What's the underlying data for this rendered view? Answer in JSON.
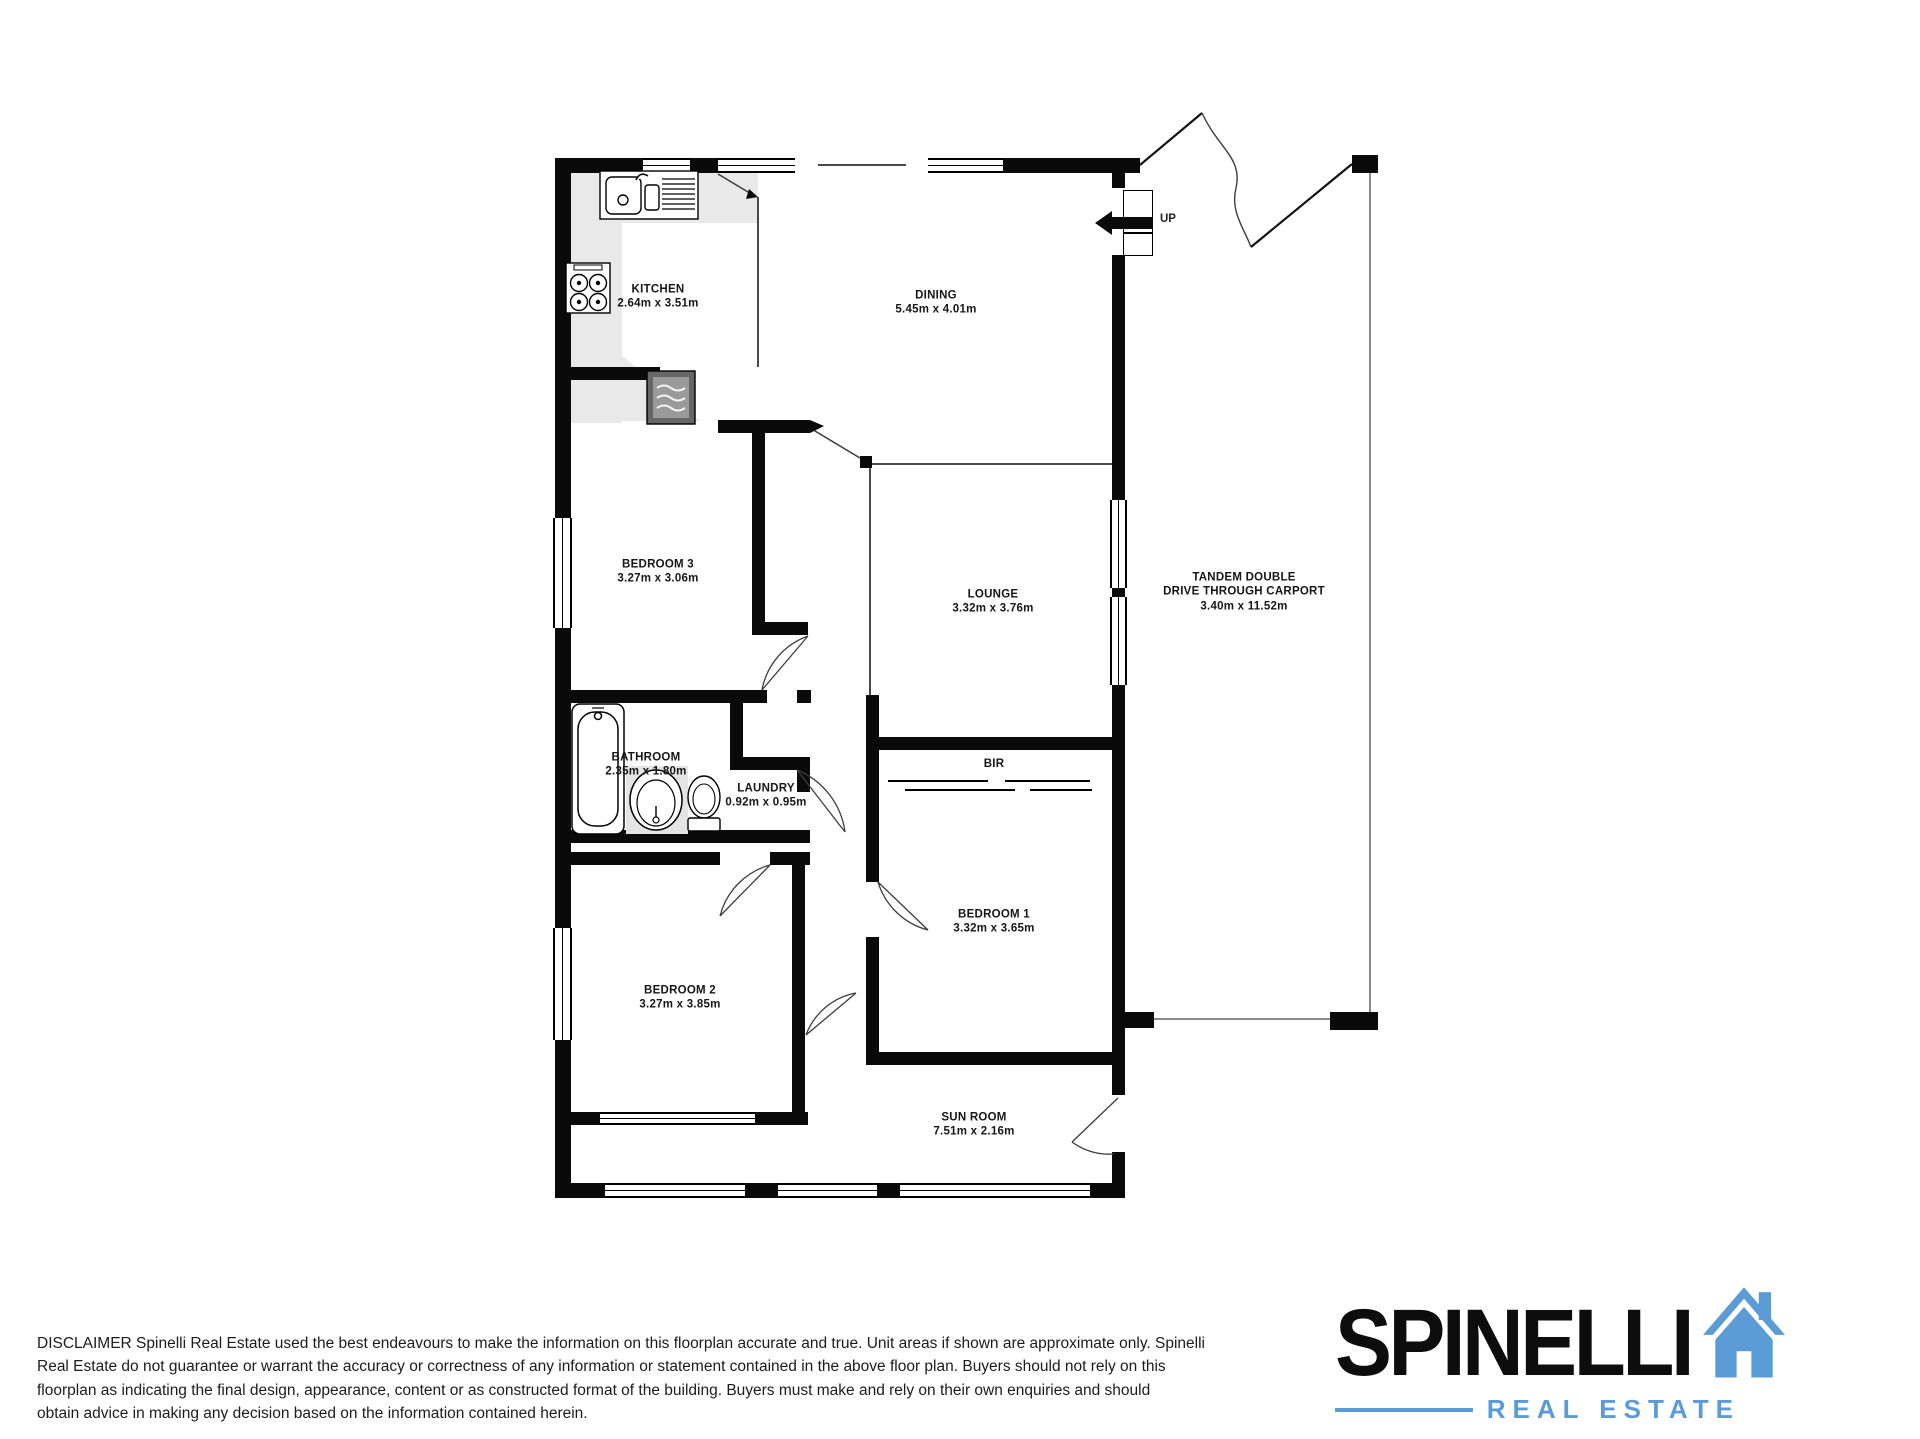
{
  "floorplan": {
    "rooms": [
      {
        "name": "KITCHEN",
        "dims": "2.64m  x 3.51m"
      },
      {
        "name": "DINING",
        "dims": "5.45m  x 4.01m"
      },
      {
        "name": "BEDROOM 3",
        "dims": "3.27m  x 3.06m"
      },
      {
        "name": "LOUNGE",
        "dims": "3.32m  x 3.76m"
      },
      {
        "name": "TANDEM DOUBLE\nDRIVE THROUGH CARPORT",
        "dims": "3.40m  x 11.52m"
      },
      {
        "name": "BATHROOM",
        "dims": "2.35m  x 1.80m"
      },
      {
        "name": "LAUNDRY",
        "dims": "0.92m  x 0.95m"
      },
      {
        "name": "BIR",
        "dims": ""
      },
      {
        "name": "BEDROOM 1",
        "dims": "3.32m  x 3.65m"
      },
      {
        "name": "BEDROOM 2",
        "dims": "3.27m  x 3.85m"
      },
      {
        "name": "SUN ROOM",
        "dims": "7.51m  x 2.16m"
      }
    ],
    "stair_label": "UP",
    "icons": {
      "kitchen_sink": "sink-icon",
      "cooktop": "stove-icon",
      "heater": "heater-icon",
      "bathtub": "bathtub-icon",
      "basin": "basin-icon",
      "toilet": "toilet-icon",
      "staircase": "stairs-icon"
    }
  },
  "disclaimer": "DISCLAIMER Spinelli Real Estate used the best endeavours to make the information on this floorplan accurate and true. Unit areas if shown are approximate only. Spinelli\nReal Estate do not guarantee or warrant the accuracy or correctness of any information or statement contained in the above floor plan. Buyers should not rely on this\nfloorplan as indicating the final design, appearance, content or as constructed format of the building. Buyers must make and rely on their own enquiries and should\nobtain advice in making any decision based on the information contained herein.",
  "logo": {
    "brand": "SPINELLI",
    "tagline": "REAL ESTATE",
    "accent_color": "#5B9CD6"
  }
}
